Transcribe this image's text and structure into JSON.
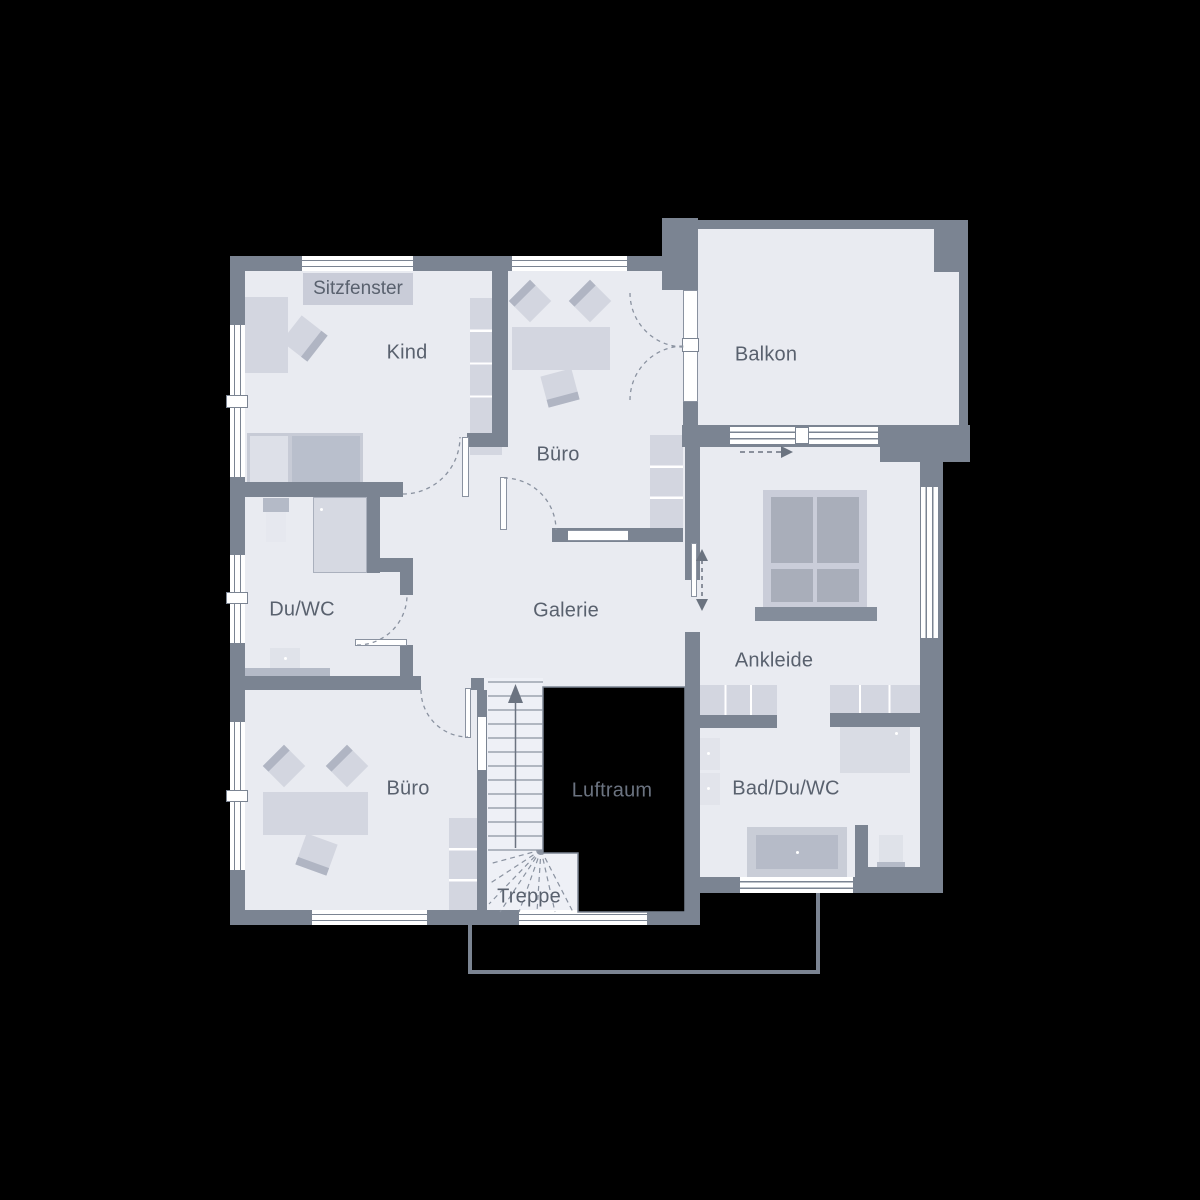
{
  "plan": {
    "labels": {
      "sitzfenster": "Sitzfenster",
      "kind": "Kind",
      "buero_top": "Büro",
      "balkon": "Balkon",
      "du_wc": "Du/WC",
      "galerie": "Galerie",
      "ankleide": "Ankleide",
      "buero_bottom": "Büro",
      "luftraum": "Luftraum",
      "bad_du_wc": "Bad/Du/WC",
      "treppe": "Treppe"
    },
    "colors": {
      "background": "#000000",
      "wall": "#7b8492",
      "floor": "#e9ebf1",
      "furniture": "#d3d6e0",
      "furniture_dark": "#b0b5c3",
      "furniture_mid": "#c7cbd6",
      "label_text": "#59616e",
      "luftraum_text": "#6b7380",
      "line": "#8a92a0",
      "window": "#ffffff"
    }
  }
}
